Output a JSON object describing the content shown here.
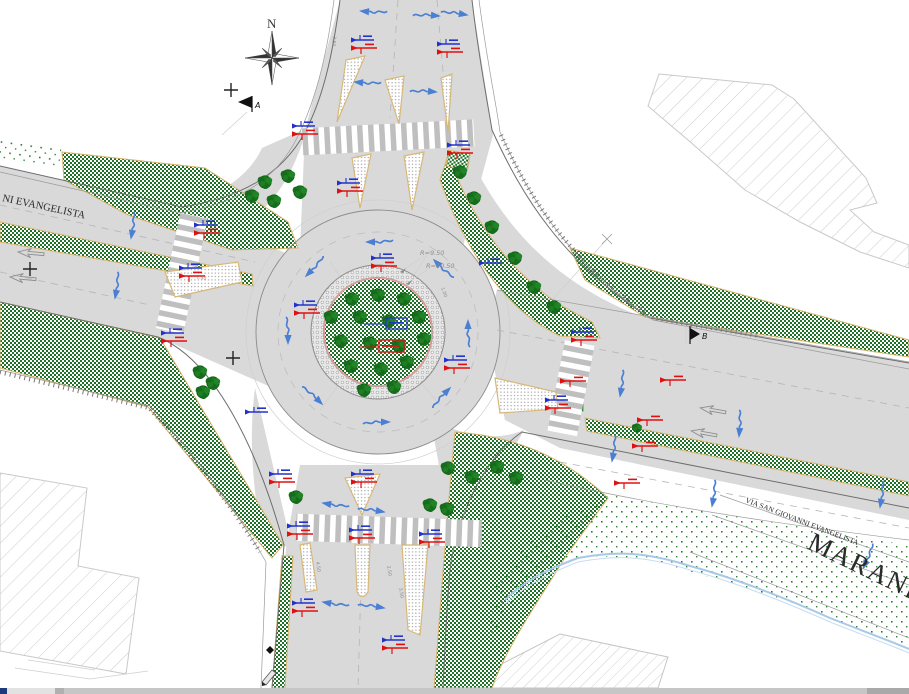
{
  "drawing": {
    "type": "road-design site plan, roundabout",
    "labels": {
      "north": "N",
      "section_a": "A",
      "section_b": "B",
      "street_left": "NI EVANGELISTA",
      "street_right": "VIA SAN GIOVANNI EVANGELISTA",
      "city": "MARANELLO",
      "r_inner": "R=9.50",
      "r_outer": "R=10.50",
      "apron_width": "1.00",
      "red_dim": "1.50"
    },
    "dims": [
      {
        "t": "4.50",
        "x": 316,
        "y": 562,
        "r": 80
      },
      {
        "t": "2.50",
        "x": 387,
        "y": 566,
        "r": 80
      },
      {
        "t": "3.50",
        "x": 399,
        "y": 588,
        "r": 80
      },
      {
        "t": "3.50",
        "x": 333,
        "y": 36,
        "r": 95
      },
      {
        "t": "1.00",
        "x": 441,
        "y": 288,
        "r": 70
      }
    ],
    "colors": {
      "road": "#d9d9d9",
      "road_edge": "#6e6e6e",
      "veg_green": "#22772b",
      "stipple_green": "#2e7d32",
      "island_tan": "#d8b878",
      "apron_pink": "#e89c9c",
      "marker_blue": "#2233cc",
      "marker_red": "#e01010",
      "arrow_blue": "#4a7fd4",
      "stream_blue": "#a8c8e8",
      "hatch_gray": "#cccccc",
      "scroll_track": "#c6c6c6",
      "scroll_chip": "#1d3b7c"
    },
    "symbols": {
      "trees": [
        [
          378,
          295
        ],
        [
          352,
          299
        ],
        [
          404,
          299
        ],
        [
          331,
          317
        ],
        [
          360,
          317
        ],
        [
          389,
          321
        ],
        [
          419,
          317
        ],
        [
          341,
          341
        ],
        [
          370,
          343
        ],
        [
          399,
          346
        ],
        [
          424,
          339
        ],
        [
          351,
          366
        ],
        [
          381,
          369
        ],
        [
          407,
          362
        ],
        [
          364,
          390
        ],
        [
          394,
          387
        ],
        [
          265,
          182
        ],
        [
          288,
          176
        ],
        [
          252,
          196
        ],
        [
          300,
          192
        ],
        [
          274,
          201
        ],
        [
          460,
          172
        ],
        [
          474,
          198
        ],
        [
          492,
          227
        ],
        [
          515,
          258
        ],
        [
          534,
          287
        ],
        [
          554,
          307
        ],
        [
          448,
          468
        ],
        [
          472,
          477
        ],
        [
          497,
          467
        ],
        [
          516,
          478
        ],
        [
          430,
          505
        ],
        [
          447,
          509
        ],
        [
          296,
          497
        ],
        [
          200,
          372
        ],
        [
          213,
          383
        ],
        [
          203,
          392
        ],
        [
          637,
          428,
          0,
          0.7
        ]
      ],
      "flow_arrows": [
        [
          378,
          242,
          180
        ],
        [
          314,
          268,
          135
        ],
        [
          288,
          332,
          90
        ],
        [
          314,
          396,
          45
        ],
        [
          378,
          422,
          0
        ],
        [
          442,
          396,
          315
        ],
        [
          468,
          332,
          270
        ],
        [
          442,
          268,
          225
        ],
        [
          372,
          12,
          185
        ],
        [
          428,
          15,
          5
        ],
        [
          456,
          13,
          10
        ],
        [
          366,
          83,
          185
        ],
        [
          425,
          91,
          5
        ],
        [
          133,
          227,
          100
        ],
        [
          117,
          287,
          100
        ],
        [
          334,
          505,
          190
        ],
        [
          373,
          510,
          10
        ],
        [
          334,
          604,
          190
        ],
        [
          373,
          606,
          10
        ],
        [
          622,
          385,
          100
        ],
        [
          614,
          450,
          100
        ],
        [
          740,
          425,
          95
        ],
        [
          714,
          495,
          100
        ],
        [
          882,
          496,
          100
        ],
        [
          868,
          558,
          115
        ]
      ],
      "ghost_arrows": [
        [
          30,
          253,
          185
        ],
        [
          22,
          278,
          185
        ],
        [
          712,
          410,
          190
        ],
        [
          703,
          433,
          190
        ]
      ],
      "marker_pairs": [
        [
          362,
          40
        ],
        [
          448,
          44
        ],
        [
          458,
          145
        ],
        [
          348,
          183
        ],
        [
          303,
          126
        ],
        [
          205,
          225
        ],
        [
          190,
          268
        ],
        [
          172,
          333
        ],
        [
          382,
          258
        ],
        [
          305,
          305
        ],
        [
          455,
          360
        ],
        [
          582,
          332
        ],
        [
          556,
          400
        ],
        [
          280,
          474
        ],
        [
          362,
          474
        ],
        [
          298,
          526
        ],
        [
          360,
          530
        ],
        [
          430,
          534
        ],
        [
          303,
          603
        ],
        [
          393,
          640
        ]
      ],
      "red_markers": [
        [
          573,
          381
        ],
        [
          673,
          380
        ],
        [
          650,
          420
        ],
        [
          645,
          446
        ],
        [
          627,
          483
        ]
      ],
      "blue_markers": [
        [
          256,
          412
        ],
        [
          490,
          263
        ]
      ]
    }
  },
  "scrollbar": {
    "orientation": "horizontal",
    "parts": [
      "corner-chip",
      "page-left-area",
      "left-button",
      "track",
      "right-button"
    ]
  }
}
